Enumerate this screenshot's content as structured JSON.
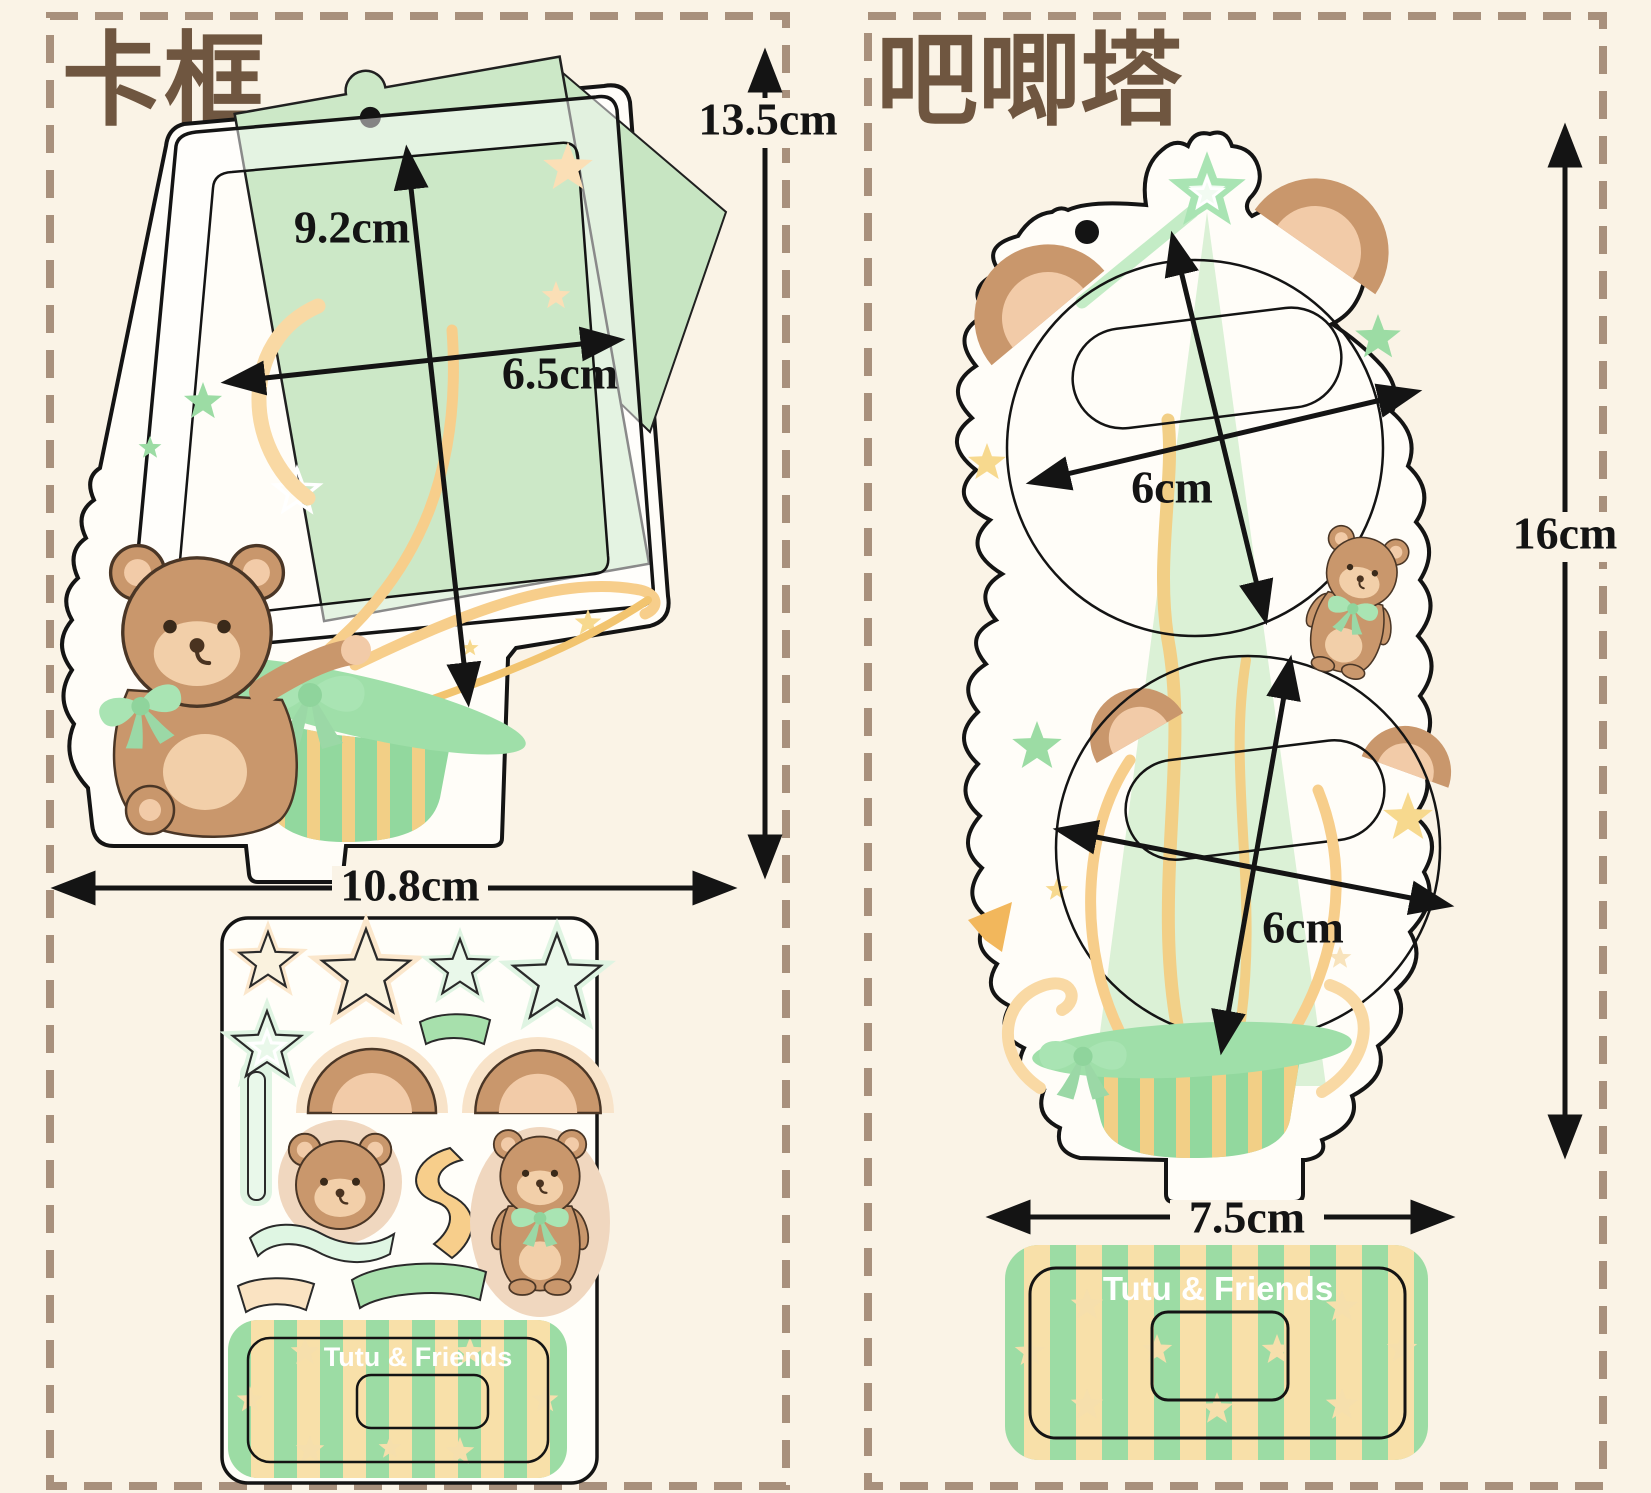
{
  "left_panel": {
    "title": "卡框",
    "dims": {
      "inner_height": "9.2cm",
      "inner_width": "6.5cm",
      "total_height": "13.5cm",
      "total_width": "10.8cm"
    },
    "base_text": "Tutu & Friends"
  },
  "right_panel": {
    "title": "吧唧塔",
    "dims": {
      "top_badge_diameter": "6cm",
      "bottom_badge_diameter": "6cm",
      "total_height": "16cm",
      "base_width": "7.5cm"
    },
    "base_text": "Tutu & Friends"
  },
  "colors": {
    "background": "#FAF3E6",
    "dashed_border": "#A8907C",
    "title_brown": "#6F5640",
    "outline_black": "#141414",
    "card_green": "#CCE8C7",
    "beam_green": "#DBF1D6",
    "mint_bow": "#A9E4B3",
    "basket_green": "#92D89E",
    "stripe_yellow": "#F2CF86",
    "base_green": "#9CDCA4",
    "base_stripe_cream": "#F8E0A9",
    "bear_brown": "#C9976C",
    "bear_light": "#F2CFA9",
    "ribbon_yellow": "#F7CE8B",
    "star_cream": "#F8E3BC",
    "star_green": "#BCE8BA"
  }
}
